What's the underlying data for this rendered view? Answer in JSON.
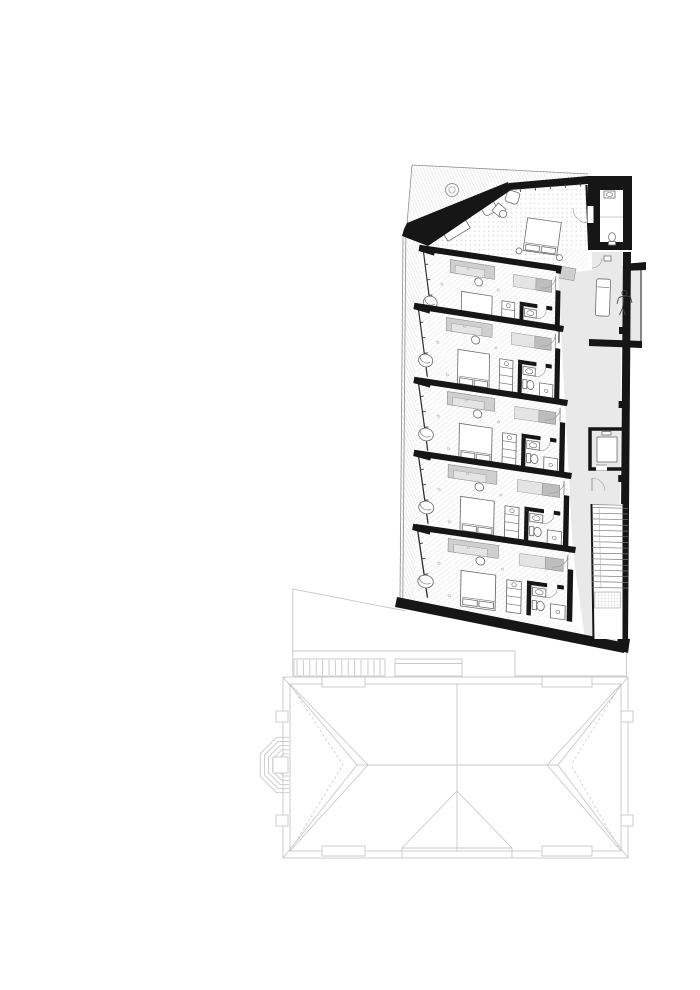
{
  "drawing": {
    "kind": "architectural-floor-plan",
    "has_text_labels": false,
    "upper_plan": {
      "rooms": [
        {
          "name": "suite",
          "furniture": [
            "bed",
            "two-armchairs",
            "pouf",
            "side-table",
            "sideboard",
            "tv-bench",
            "closet",
            "plant"
          ]
        },
        {
          "name": "guest-room-1",
          "furniture": [
            "bed",
            "wardrobe",
            "desk-chair",
            "lounge-chair",
            "minibar",
            "bathroom"
          ]
        },
        {
          "name": "guest-room-2",
          "furniture": [
            "bed",
            "wardrobe",
            "desk-chair",
            "lounge-chair",
            "minibar",
            "bathroom"
          ]
        },
        {
          "name": "guest-room-3",
          "furniture": [
            "bed",
            "wardrobe",
            "desk-chair",
            "lounge-chair",
            "minibar",
            "bathroom"
          ]
        },
        {
          "name": "guest-room-4",
          "furniture": [
            "bed",
            "wardrobe",
            "desk-chair",
            "lounge-chair",
            "minibar",
            "bathroom"
          ]
        },
        {
          "name": "guest-room-5",
          "furniture": [
            "bed",
            "wardrobe",
            "desk-chair",
            "lounge-chair",
            "minibar",
            "bathroom"
          ]
        }
      ],
      "core": {
        "elevator": 1,
        "staircase_treads": 15,
        "top_bathroom": 1
      },
      "terrace": {
        "items": [
          "sunbed",
          "person-figure"
        ]
      },
      "guest_room_count": 5
    },
    "existing_building": {
      "roof_type": "hipped",
      "turret_rings": 5,
      "roof_access": [
        "ladder-band",
        "hatch-box"
      ]
    }
  },
  "colors": {
    "background": "#ffffff",
    "wall": "#161616",
    "floor_gray": "#e9e9e9",
    "hatch": "#d6d6d6",
    "hatch_steep": "#c9c9c9",
    "dots": "#c9c9c9",
    "furniture_gray": "#cfcfcf",
    "furniture_gray_dark": "#bdbdbd",
    "furniture_gray_light": "#e4e4e4",
    "fixture_line": "#6e6e6e",
    "faint_line": "#c8c8c8"
  }
}
